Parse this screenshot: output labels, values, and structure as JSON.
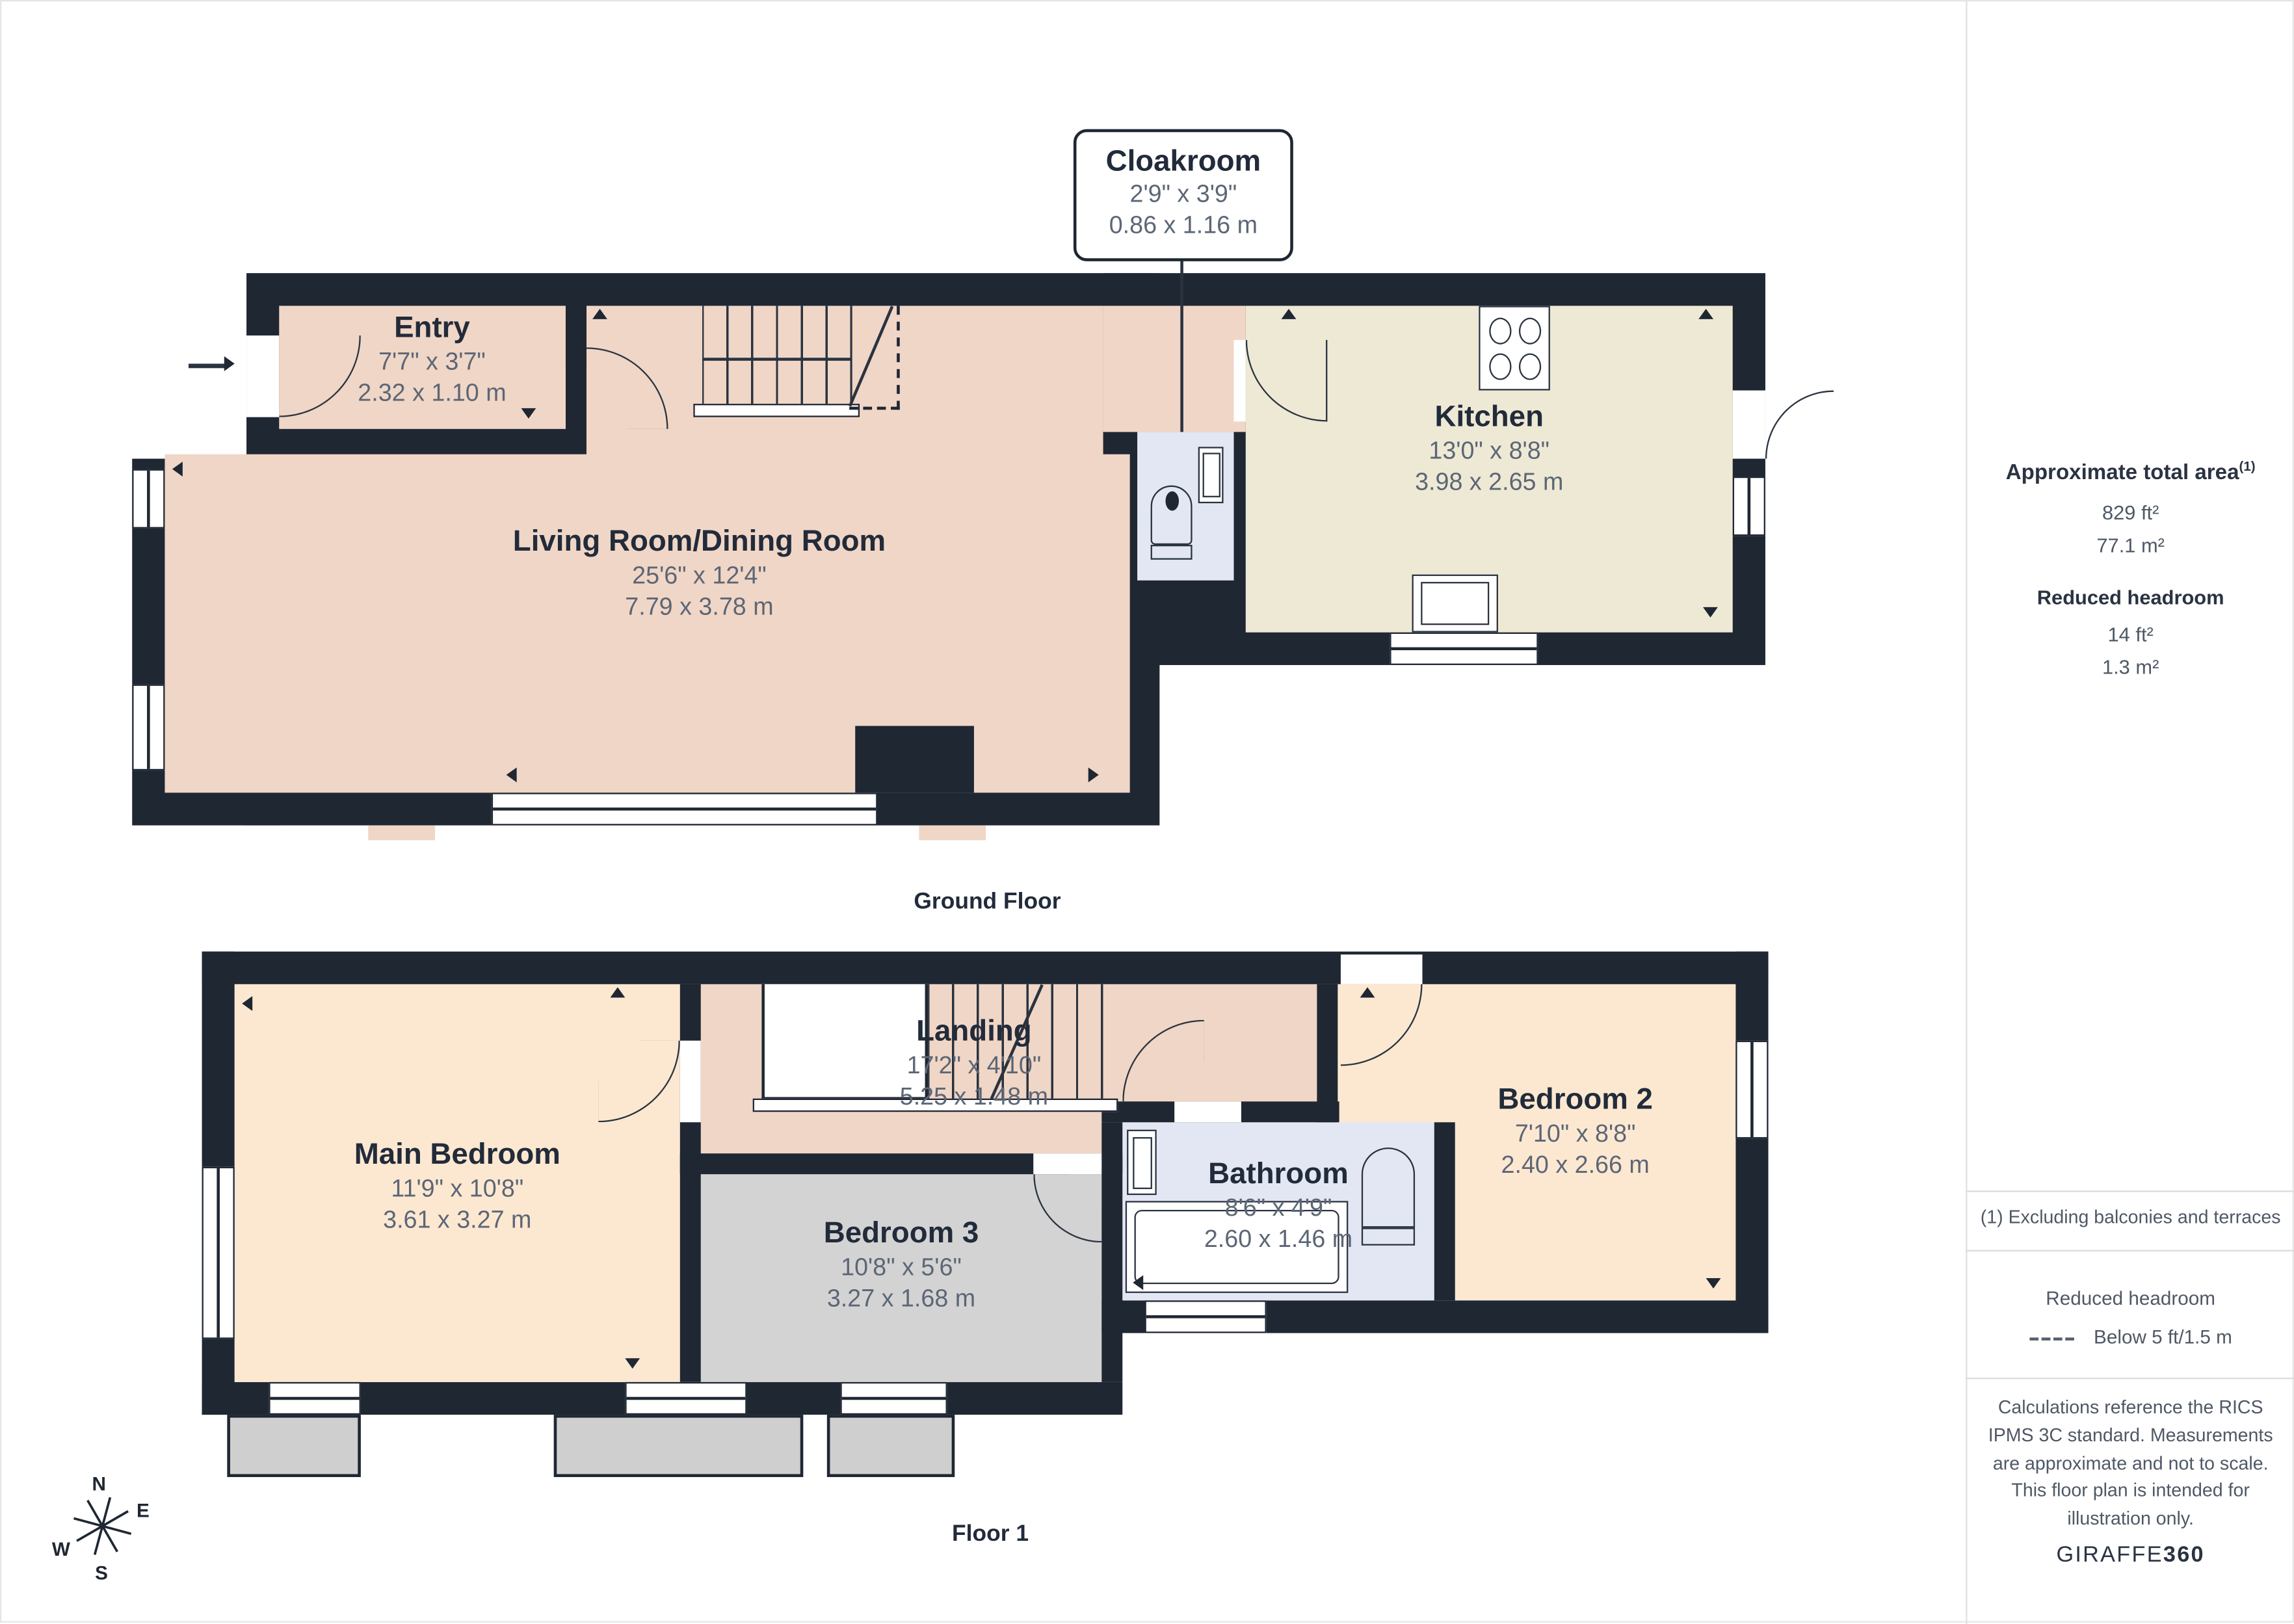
{
  "callout": {
    "title": "Cloakroom",
    "dims_imperial": "2'9\" x 3'9\"",
    "dims_metric": "0.86 x 1.16 m"
  },
  "ground_floor": {
    "caption": "Ground Floor",
    "rooms": {
      "entry": {
        "name": "Entry",
        "imperial": "7'7\" x 3'7\"",
        "metric": "2.32 x 1.10 m"
      },
      "living": {
        "name": "Living Room/Dining Room",
        "imperial": "25'6\" x 12'4\"",
        "metric": "7.79 x 3.78 m"
      },
      "kitchen": {
        "name": "Kitchen",
        "imperial": "13'0\" x 8'8\"",
        "metric": "3.98 x 2.65 m"
      }
    }
  },
  "floor1": {
    "caption": "Floor 1",
    "rooms": {
      "main_bedroom": {
        "name": "Main Bedroom",
        "imperial": "11'9\" x 10'8\"",
        "metric": "3.61 x 3.27 m"
      },
      "landing": {
        "name": "Landing",
        "imperial": "17'2\" x 4'10\"",
        "metric": "5.25 x 1.48 m"
      },
      "bedroom3": {
        "name": "Bedroom 3",
        "imperial": "10'8\" x 5'6\"",
        "metric": "3.27 x 1.68 m"
      },
      "bathroom": {
        "name": "Bathroom",
        "imperial": "8'6\" x 4'9\"",
        "metric": "2.60 x 1.46 m"
      },
      "bedroom2": {
        "name": "Bedroom 2",
        "imperial": "7'10\" x 8'8\"",
        "metric": "2.40 x 2.66 m"
      }
    }
  },
  "sidebar": {
    "area_heading": "Approximate total area",
    "area_heading_note": "(1)",
    "area_ft": "829 ft²",
    "area_m": "77.1 m²",
    "reduced_heading": "Reduced headroom",
    "reduced_ft": "14 ft²",
    "reduced_m": "1.3 m²",
    "footnote": "(1) Excluding balconies and terraces",
    "legend_heading": "Reduced headroom",
    "legend_label": "Below 5 ft/1.5 m",
    "disclaimer": "Calculations reference the RICS IPMS 3C standard. Measurements are approximate and not to scale. This floor plan is intended for illustration only.",
    "brand_regular": "GIRAFFE",
    "brand_bold": "360"
  },
  "compass": {
    "n": "N",
    "e": "E",
    "s": "S",
    "w": "W"
  },
  "colors": {
    "wall": "#1f2733",
    "living": "#f0d6c6",
    "bedroom_peach": "#fce8d1",
    "kitchen_cream": "#eee9d5",
    "wet_blue": "#e2e7f3",
    "grey_room": "#d3d3d3",
    "title_text": "#222b3a",
    "dims_text": "#5c6676"
  }
}
